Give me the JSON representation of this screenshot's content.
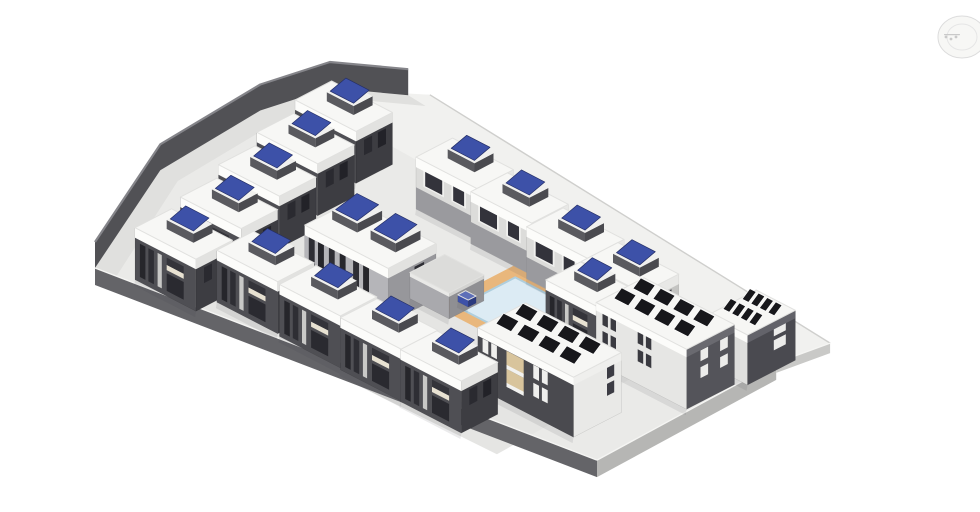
{
  "palette": {
    "background": "#ffffff",
    "site_fill": "#EAEAE8",
    "upper_plane_fill": "#F1F1EF",
    "courtyard_fill": "#E5E5E3",
    "path_fill": "#E0E0DE",
    "wall_dark": "#515155",
    "wall_top": "#85858A",
    "fascia_dark": "#646468",
    "fascia_light": "#B6B6B4",
    "fascia_pale": "#C9C9C7",
    "fascia_lip": "#F5F5F3",
    "far_edge": "#CFCFCD",
    "roof_stroke": "#E1E1DF",
    "deck_orange": "#E9B77C",
    "water_blue": "#DCEBF4",
    "water_edge": "#AFCEDD",
    "panel_blue": "#3D51A8",
    "panel_blue_frame": "#252F66",
    "panel_black": "#17171B",
    "shadow": "rgba(60,60,65,0.10)"
  },
  "nav_wheel": {
    "ring": "#D9D9D9",
    "inner_ring": "#E3E3E3",
    "fill": "#F7F7F5",
    "marks": "#C4C4C4"
  },
  "scene": {
    "projection": {
      "ax": 0.87,
      "ay": 0.45,
      "ox": 95,
      "oy": 268
    },
    "ground": {
      "site": [
        [
          0,
          0
        ],
        [
          502,
          -75
        ],
        [
          497,
          -286
        ],
        [
          506,
          -339
        ],
        [
          0,
          -385
        ],
        [
          -12,
          -372
        ],
        [
          -65,
          -335
        ],
        [
          -80,
          -270
        ],
        [
          -71,
          -146
        ]
      ],
      "upper_plane": [
        [
          -20,
          -308
        ],
        [
          497,
          -288
        ],
        [
          506,
          -339
        ],
        [
          0,
          -385
        ],
        [
          -50,
          -345
        ]
      ],
      "courtyard": [
        [
          55,
          -212
        ],
        [
          430,
          -204
        ],
        [
          438,
          -24
        ],
        [
          62,
          -16
        ]
      ],
      "far_edge_line": [
        [
          506,
          -339
        ],
        [
          0,
          -385
        ]
      ],
      "boundary_wall": {
        "pts": [
          [
            0,
            0
          ],
          [
            -71,
            -146
          ],
          [
            -80,
            -270
          ],
          [
            -65,
            -335
          ],
          [
            -12,
            -372
          ]
        ],
        "height": 26
      },
      "path_inner": [
        [
          22,
          -2
        ],
        [
          -49,
          -144
        ],
        [
          -58,
          -268
        ],
        [
          -43,
          -333
        ],
        [
          10,
          -370
        ]
      ],
      "fascias": [
        {
          "name": "plate-edge-southwest",
          "a": [
            0,
            0
          ],
          "b": [
            502,
            -75
          ],
          "depth": 17,
          "fill": "#646468"
        },
        {
          "name": "plate-edge-southeast",
          "a": [
            502,
            -75
          ],
          "b": [
            497,
            -286
          ],
          "depth": 17,
          "fill": "#B6B6B4"
        },
        {
          "name": "plate-edge-east",
          "a": [
            497,
            -286
          ],
          "b": [
            506,
            -339
          ],
          "depth": 10,
          "fill": "#C9C9C7"
        }
      ]
    },
    "pool": {
      "deck": {
        "x": 238,
        "y": -245,
        "w": 84,
        "d": 92
      },
      "water": {
        "x": 252,
        "y": -231,
        "w": 58,
        "d": 66
      }
    },
    "styles": {
      "houseDark": {
        "front": "#4F4F54",
        "right": "#3D3D42",
        "roof": "#F7F7F5",
        "frontBand": "#FCFCFA",
        "rightBand": "#E2E2E0",
        "bandH": 10,
        "rooftop": "bluePanel",
        "units": 1,
        "windows": [
          {
            "f": "FL",
            "u1": 0.08,
            "v1": 0.1,
            "u2": 0.17,
            "v2": 0.74,
            "c": "#26262B"
          },
          {
            "f": "FL",
            "u1": 0.22,
            "v1": 0.1,
            "u2": 0.31,
            "v2": 0.74,
            "c": "#2E2E34"
          },
          {
            "f": "FL",
            "u1": 0.37,
            "v1": 0.1,
            "u2": 0.44,
            "v2": 0.74,
            "c": "#C9C9C7"
          },
          {
            "f": "FL",
            "u1": 0.52,
            "v1": 0.1,
            "u2": 0.8,
            "v2": 0.44,
            "c": "#2A2A30"
          },
          {
            "f": "FL",
            "u1": 0.52,
            "v1": 0.5,
            "u2": 0.8,
            "v2": 0.6,
            "c": "#E8E2D2"
          },
          {
            "f": "FL",
            "u1": 0.52,
            "v1": 0.6,
            "u2": 0.8,
            "v2": 0.74,
            "c": "#34343A"
          },
          {
            "f": "FR",
            "u1": 0.18,
            "v1": 0.46,
            "u2": 0.4,
            "v2": 0.76,
            "c": "#222228"
          },
          {
            "f": "FR",
            "u1": 0.56,
            "v1": 0.46,
            "u2": 0.78,
            "v2": 0.76,
            "c": "#2A2A30"
          }
        ]
      },
      "houseLight": {
        "front": "#DCDCDA",
        "right": "#C4C4C2",
        "roof": "#F7F7F5",
        "frontBand": "#FCFCFA",
        "rightBand": "#E8E8E6",
        "bandH": 10,
        "rooftop": "bluePanel",
        "units": 1,
        "windows": [
          {
            "f": "FL",
            "u1": 0.0,
            "v1": 0.0,
            "u2": 1.0,
            "v2": 0.42,
            "c": "#9A9A9E"
          },
          {
            "f": "FL",
            "u1": 0.12,
            "v1": 0.5,
            "u2": 0.46,
            "v2": 0.84,
            "c": "#F0F0EE"
          },
          {
            "f": "FL",
            "u1": 0.15,
            "v1": 0.53,
            "u2": 0.43,
            "v2": 0.81,
            "c": "#33333B"
          },
          {
            "f": "FL",
            "u1": 0.58,
            "v1": 0.5,
            "u2": 0.82,
            "v2": 0.84,
            "c": "#F0F0EE"
          },
          {
            "f": "FL",
            "u1": 0.61,
            "v1": 0.53,
            "u2": 0.79,
            "v2": 0.81,
            "c": "#33333B"
          },
          {
            "f": "FR",
            "u1": 0.2,
            "v1": 0.46,
            "u2": 0.42,
            "v2": 0.78,
            "c": "#3A3A42"
          },
          {
            "f": "FR",
            "u1": 0.56,
            "v1": 0.46,
            "u2": 0.78,
            "v2": 0.78,
            "c": "#3A3A42"
          }
        ]
      },
      "duplex": {
        "front": "#B5B5B9",
        "right": "#97979B",
        "roof": "#F7F7F5",
        "frontBand": "#FCFCFA",
        "rightBand": "#E2E2E0",
        "bandH": 10,
        "rooftop": "bluePanel",
        "units": 2,
        "windows": [
          {
            "f": "FL",
            "u1": 0.05,
            "v1": 0.08,
            "u2": 0.12,
            "v2": 0.82,
            "c": "#2E2E34"
          },
          {
            "f": "FL",
            "u1": 0.16,
            "v1": 0.08,
            "u2": 0.23,
            "v2": 0.82,
            "c": "#26262B"
          },
          {
            "f": "FL",
            "u1": 0.29,
            "v1": 0.08,
            "u2": 0.36,
            "v2": 0.82,
            "c": "#2E2E34"
          },
          {
            "f": "FL",
            "u1": 0.42,
            "v1": 0.08,
            "u2": 0.49,
            "v2": 0.82,
            "c": "#26262B"
          },
          {
            "f": "FL",
            "u1": 0.58,
            "v1": 0.08,
            "u2": 0.65,
            "v2": 0.82,
            "c": "#2E2E34"
          },
          {
            "f": "FL",
            "u1": 0.7,
            "v1": 0.08,
            "u2": 0.77,
            "v2": 0.82,
            "c": "#26262B"
          },
          {
            "f": "FR",
            "u1": 0.25,
            "v1": 0.45,
            "u2": 0.45,
            "v2": 0.78,
            "c": "#2E2E34"
          }
        ]
      },
      "apartmentA": {
        "front": "#4A4A4F",
        "right": "#E9E9E7",
        "roof": "#F6F6F4",
        "frontBand": "#FCFCFA",
        "rightBand": "#EFEFED",
        "bandH": 8,
        "rooftop": "solarArray",
        "units": 1,
        "windows": [
          {
            "f": "FL",
            "u1": 0.05,
            "v1": 0.34,
            "u2": 0.11,
            "v2": 0.56,
            "c": "#EFEFED"
          },
          {
            "f": "FL",
            "u1": 0.14,
            "v1": 0.34,
            "u2": 0.2,
            "v2": 0.56,
            "c": "#EFEFED"
          },
          {
            "f": "FL",
            "u1": 0.05,
            "v1": 0.64,
            "u2": 0.11,
            "v2": 0.86,
            "c": "#EFEFED"
          },
          {
            "f": "FL",
            "u1": 0.14,
            "v1": 0.64,
            "u2": 0.2,
            "v2": 0.86,
            "c": "#EFEFED"
          },
          {
            "f": "FL",
            "u1": 0.3,
            "v1": 0.3,
            "u2": 0.48,
            "v2": 0.56,
            "c": "#D8C49C"
          },
          {
            "f": "FL",
            "u1": 0.3,
            "v1": 0.26,
            "u2": 0.48,
            "v2": 0.33,
            "c": "#F2F2F0"
          },
          {
            "f": "FL",
            "u1": 0.3,
            "v1": 0.6,
            "u2": 0.48,
            "v2": 0.86,
            "c": "#D8C49C"
          },
          {
            "f": "FL",
            "u1": 0.3,
            "v1": 0.56,
            "u2": 0.48,
            "v2": 0.63,
            "c": "#F2F2F0"
          },
          {
            "f": "FL",
            "u1": 0.58,
            "v1": 0.34,
            "u2": 0.64,
            "v2": 0.56,
            "c": "#EFEFED"
          },
          {
            "f": "FL",
            "u1": 0.67,
            "v1": 0.34,
            "u2": 0.73,
            "v2": 0.56,
            "c": "#EFEFED"
          },
          {
            "f": "FL",
            "u1": 0.58,
            "v1": 0.64,
            "u2": 0.64,
            "v2": 0.86,
            "c": "#EFEFED"
          },
          {
            "f": "FL",
            "u1": 0.67,
            "v1": 0.64,
            "u2": 0.73,
            "v2": 0.86,
            "c": "#EFEFED"
          },
          {
            "f": "FR",
            "u1": 0.15,
            "v1": 0.4,
            "u2": 0.3,
            "v2": 0.6,
            "c": "#3C3C44"
          },
          {
            "f": "FR",
            "u1": 0.15,
            "v1": 0.68,
            "u2": 0.3,
            "v2": 0.88,
            "c": "#3C3C44"
          }
        ]
      },
      "apartmentB": {
        "front": "#E6E6E4",
        "right": "#54545A",
        "roof": "#F6F6F4",
        "frontBand": "#FCFCFA",
        "rightBand": "#6A6A70",
        "bandH": 8,
        "rooftop": "solarArray",
        "units": 1,
        "windows": [
          {
            "f": "FL",
            "u1": 0.07,
            "v1": 0.38,
            "u2": 0.13,
            "v2": 0.58,
            "c": "#3A3A40"
          },
          {
            "f": "FL",
            "u1": 0.16,
            "v1": 0.38,
            "u2": 0.22,
            "v2": 0.58,
            "c": "#3A3A40"
          },
          {
            "f": "FL",
            "u1": 0.07,
            "v1": 0.68,
            "u2": 0.13,
            "v2": 0.88,
            "c": "#3A3A40"
          },
          {
            "f": "FL",
            "u1": 0.16,
            "v1": 0.68,
            "u2": 0.22,
            "v2": 0.88,
            "c": "#3A3A40"
          },
          {
            "f": "FL",
            "u1": 0.46,
            "v1": 0.38,
            "u2": 0.52,
            "v2": 0.58,
            "c": "#3A3A40"
          },
          {
            "f": "FL",
            "u1": 0.55,
            "v1": 0.38,
            "u2": 0.61,
            "v2": 0.58,
            "c": "#3A3A40"
          },
          {
            "f": "FL",
            "u1": 0.46,
            "v1": 0.68,
            "u2": 0.52,
            "v2": 0.88,
            "c": "#3A3A40"
          },
          {
            "f": "FL",
            "u1": 0.55,
            "v1": 0.68,
            "u2": 0.61,
            "v2": 0.88,
            "c": "#3A3A40"
          },
          {
            "f": "FR",
            "u1": 0.14,
            "v1": 0.4,
            "u2": 0.3,
            "v2": 0.58,
            "c": "#ECECEA"
          },
          {
            "f": "FR",
            "u1": 0.14,
            "v1": 0.68,
            "u2": 0.3,
            "v2": 0.86,
            "c": "#ECECEA"
          },
          {
            "f": "FR",
            "u1": 0.55,
            "v1": 0.4,
            "u2": 0.71,
            "v2": 0.58,
            "c": "#ECECEA"
          },
          {
            "f": "FR",
            "u1": 0.55,
            "v1": 0.68,
            "u2": 0.71,
            "v2": 0.86,
            "c": "#ECECEA"
          }
        ]
      },
      "apartmentC": {
        "front": "#DFDFDD",
        "right": "#4A4A50",
        "roof": "#F6F6F4",
        "frontBand": "#FCFCFA",
        "rightBand": "#63636A",
        "bandH": 8,
        "rooftop": "solarArray",
        "units": 1,
        "windows": [
          {
            "f": "FR",
            "u1": 0.2,
            "v1": 0.42,
            "u2": 0.45,
            "v2": 0.62,
            "c": "#ECECEA"
          },
          {
            "f": "FR",
            "u1": 0.2,
            "v1": 0.7,
            "u2": 0.45,
            "v2": 0.88,
            "c": "#ECECEA"
          },
          {
            "f": "FL",
            "u1": 0.3,
            "v1": 0.4,
            "u2": 0.5,
            "v2": 0.6,
            "c": "#3C3C44"
          }
        ]
      },
      "plain": {
        "front": "#A9A9AD",
        "right": "#8F8F93",
        "roof": "#DCDCDA",
        "frontBand": "#E9E9E7",
        "rightBand": "#D2D2D0",
        "bandH": 4,
        "rooftop": "none",
        "units": 0,
        "windows": []
      },
      "blueBox": {
        "front": "#3D51A8",
        "right": "#2B3A7E",
        "roof": "#5E6FB8",
        "frontBand": "#3D51A8",
        "rightBand": "#2B3A7E",
        "bandH": 0,
        "rooftop": "none",
        "units": 0,
        "windows": []
      }
    },
    "blue_panel": {
      "c": "#3D51A8",
      "curb": "#5A5A5F",
      "curbD": "#4A4A4F",
      "top": "#F0F0EE"
    },
    "solar_array": {
      "rows": 2,
      "cols": 4,
      "c": "#17171B"
    },
    "buildings": [
      {
        "id": "house-left-1",
        "type": "houseDark",
        "x": -14,
        "y": -286,
        "w": 70,
        "d": 42,
        "h": 52
      },
      {
        "id": "house-left-2",
        "type": "houseDark",
        "x": 0,
        "y": -228,
        "w": 70,
        "d": 42,
        "h": 52
      },
      {
        "id": "house-left-3",
        "type": "houseDark",
        "x": 14,
        "y": -170,
        "w": 70,
        "d": 42,
        "h": 52
      },
      {
        "id": "house-left-4",
        "type": "houseDark",
        "x": 28,
        "y": -112,
        "w": 70,
        "d": 42,
        "h": 52
      },
      {
        "id": "house-left-5",
        "type": "houseDark",
        "x": 36,
        "y": -52,
        "w": 70,
        "d": 42,
        "h": 52
      },
      {
        "id": "house-center-1",
        "type": "houseDark",
        "x": 108,
        "y": -74,
        "w": 70,
        "d": 42,
        "h": 52
      },
      {
        "id": "house-center-2",
        "type": "houseDark",
        "x": 182,
        "y": -72,
        "w": 70,
        "d": 42,
        "h": 52
      },
      {
        "id": "house-center-3",
        "type": "houseDark",
        "x": 254,
        "y": -70,
        "w": 70,
        "d": 42,
        "h": 52
      },
      {
        "id": "house-center-4",
        "type": "houseDark",
        "x": 324,
        "y": -69,
        "w": 70,
        "d": 42,
        "h": 52
      },
      {
        "id": "house-right-1",
        "type": "houseLight",
        "x": 119,
        "y": -292,
        "w": 70,
        "d": 42,
        "h": 52
      },
      {
        "id": "house-right-2",
        "type": "houseLight",
        "x": 189,
        "y": -285,
        "w": 70,
        "d": 42,
        "h": 52
      },
      {
        "id": "house-right-3",
        "type": "houseLight",
        "x": 260,
        "y": -278,
        "w": 70,
        "d": 42,
        "h": 52
      },
      {
        "id": "house-right-4",
        "type": "houseLight",
        "x": 330,
        "y": -271,
        "w": 70,
        "d": 42,
        "h": 52
      },
      {
        "id": "house-east",
        "type": "houseDark",
        "x": 330,
        "y": -228,
        "w": 60,
        "d": 40,
        "h": 52
      },
      {
        "id": "duplex",
        "type": "duplex",
        "x": 134,
        "y": -162,
        "w": 96,
        "d": 55,
        "h": 55
      },
      {
        "id": "pool-house",
        "type": "plain",
        "x": 215,
        "y": -187,
        "w": 45,
        "d": 40,
        "h": 26
      },
      {
        "id": "pool-feature",
        "type": "blueBox",
        "x": 246,
        "y": -180,
        "w": 12,
        "d": 9,
        "h": 7
      },
      {
        "id": "apartment-c",
        "type": "apartmentC",
        "x": 460,
        "y": -300,
        "w": 45,
        "d": 55,
        "h": 50
      },
      {
        "id": "apartment-b",
        "type": "apartmentB",
        "x": 393,
        "y": -238,
        "w": 104,
        "d": 55,
        "h": 60
      },
      {
        "id": "apartment-a",
        "type": "apartmentA",
        "x": 353,
        "y": -142,
        "w": 110,
        "d": 55,
        "h": 60
      }
    ]
  }
}
